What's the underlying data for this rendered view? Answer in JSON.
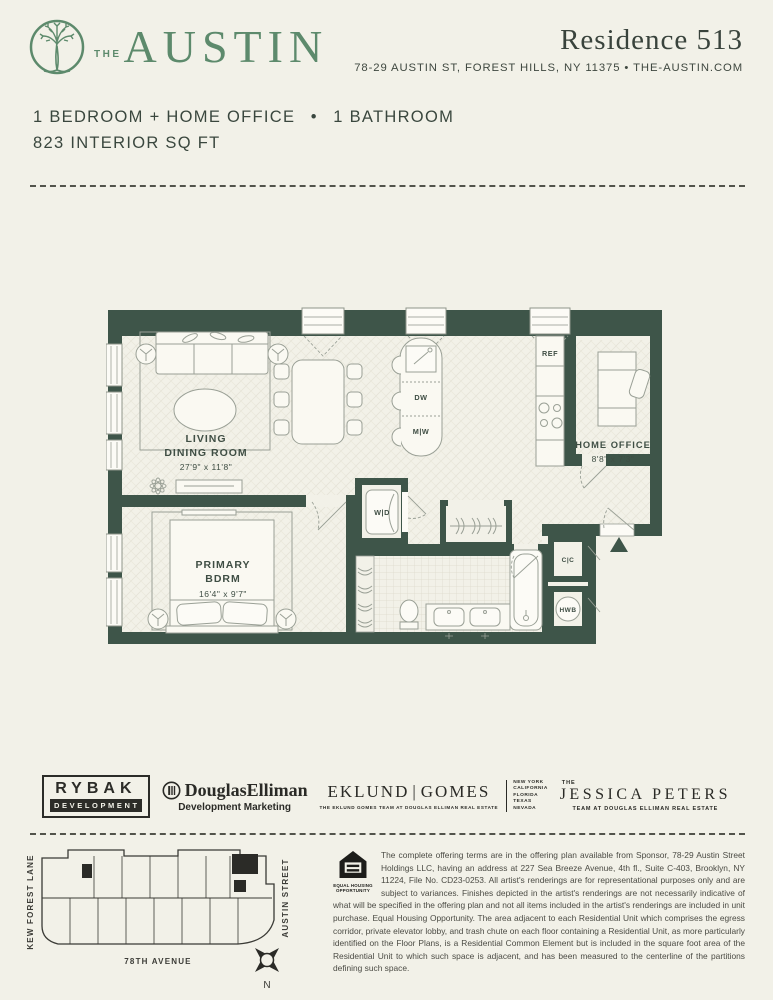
{
  "header": {
    "brand_the": "THE",
    "brand_name": "AUSTIN",
    "residence": "Residence 513",
    "address": "78-29 AUSTIN ST, FOREST HILLS, NY 11375 • THE-AUSTIN.COM"
  },
  "unit": {
    "line1": "1 BEDROOM + HOME OFFICE  •  1 BATHROOM",
    "line2": "823 INTERIOR SQ FT"
  },
  "floorplan": {
    "living": {
      "name_line1": "LIVING",
      "name_line2": "DINING ROOM",
      "dims": "27'9\" x 11'8\""
    },
    "primary": {
      "name_line1": "PRIMARY",
      "name_line2": "BDRM",
      "dims": "16'4\" x 9'7\""
    },
    "home_office": {
      "name": "HOME OFFICE",
      "dims": "8'8\" x 7'3\""
    },
    "fixtures": {
      "ref": "REF",
      "dw": "DW",
      "mw": "M|W",
      "wd": "W|D",
      "cc": "C|C",
      "hwb": "HWB"
    }
  },
  "logos": {
    "rybak": {
      "name": "RYBAK",
      "sub": "DEVELOPMENT"
    },
    "douglas_elliman": {
      "name": "DouglasElliman",
      "sub": "Development Marketing"
    },
    "eklund_gomes": {
      "name_left": "EKLUND",
      "name_right": "GOMES",
      "sub": "THE EKLUND GOMES TEAM AT DOUGLAS ELLIMAN REAL ESTATE",
      "states": [
        "NEW YORK",
        "CALIFORNIA",
        "FLORIDA",
        "TEXAS",
        "NEVADA"
      ]
    },
    "jessica_peters": {
      "the": "THE",
      "name": "JESSICA PETERS",
      "sub": "TEAM AT DOUGLAS ELLIMAN REAL ESTATE"
    }
  },
  "sitemap": {
    "street_left": "KEW FOREST LANE",
    "street_right": "AUSTIN STREET",
    "street_bottom": "78TH AVENUE",
    "compass": "N"
  },
  "legal": {
    "eho_line1": "EQUAL HOUSING",
    "eho_line2": "OPPORTUNITY",
    "disclaimer": "The complete offering terms are in the offering plan available from Sponsor, 78-29 Austin Street Holdings LLC, having an address at 227 Sea Breeze Avenue, 4th fl., Suite C-403, Brooklyn, NY 11224, File No. CD23-0253. All artist's renderings are for representational purposes only and are subject to variances. Finishes depicted in the artist's renderings are not necessarily indicative of what will be specified in the offering plan and not all items included in the artist's renderings are included in unit purchase. Equal Housing Opportunity. The area adjacent to each Residential Unit which comprises the egress corridor, private elevator lobby, and trash chute on each floor containing a Residential Unit, as more particularly identified on the Floor Plans, is a Residential Common Element but is included in the square foot area of the Residential Unit to which such space is adjacent, and has been measured to the centerline of the partitions defining such space."
  }
}
